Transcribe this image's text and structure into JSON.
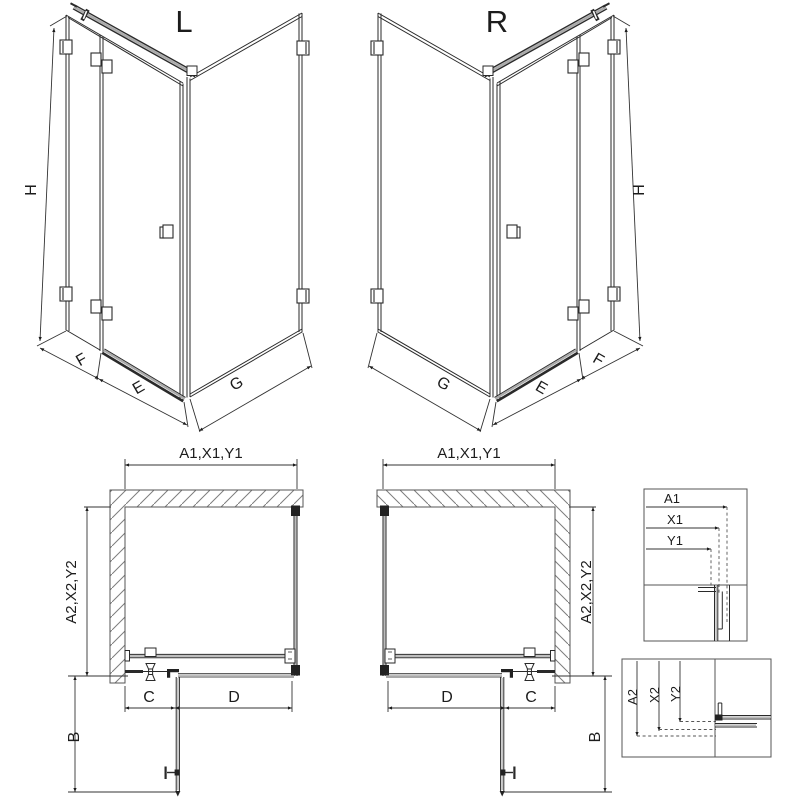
{
  "drawing": {
    "iso_left": {
      "title": "L",
      "height": "H",
      "fixed": "F",
      "door": "E",
      "side": "G"
    },
    "iso_right": {
      "title": "R",
      "height": "H",
      "fixed": "F",
      "door": "E",
      "side": "G"
    },
    "plan_left": {
      "width": "A1,X1,Y1",
      "depth": "A2,X2,Y2",
      "door": "C",
      "fixed": "D",
      "swing": "B"
    },
    "plan_right": {
      "width": "A1,X1,Y1",
      "depth": "A2,X2,Y2",
      "door": "C",
      "fixed": "D",
      "swing": "B"
    },
    "detail_width": {
      "a": "A1",
      "x": "X1",
      "y": "Y1"
    },
    "detail_depth": {
      "a": "A2",
      "x": "X2",
      "y": "Y2"
    },
    "colors": {
      "line": "#1c1c1c",
      "glass": "#2a2a2a",
      "gray": "#aaaaaa",
      "hatch": "#7d7d7d",
      "dim": "#333333"
    }
  }
}
